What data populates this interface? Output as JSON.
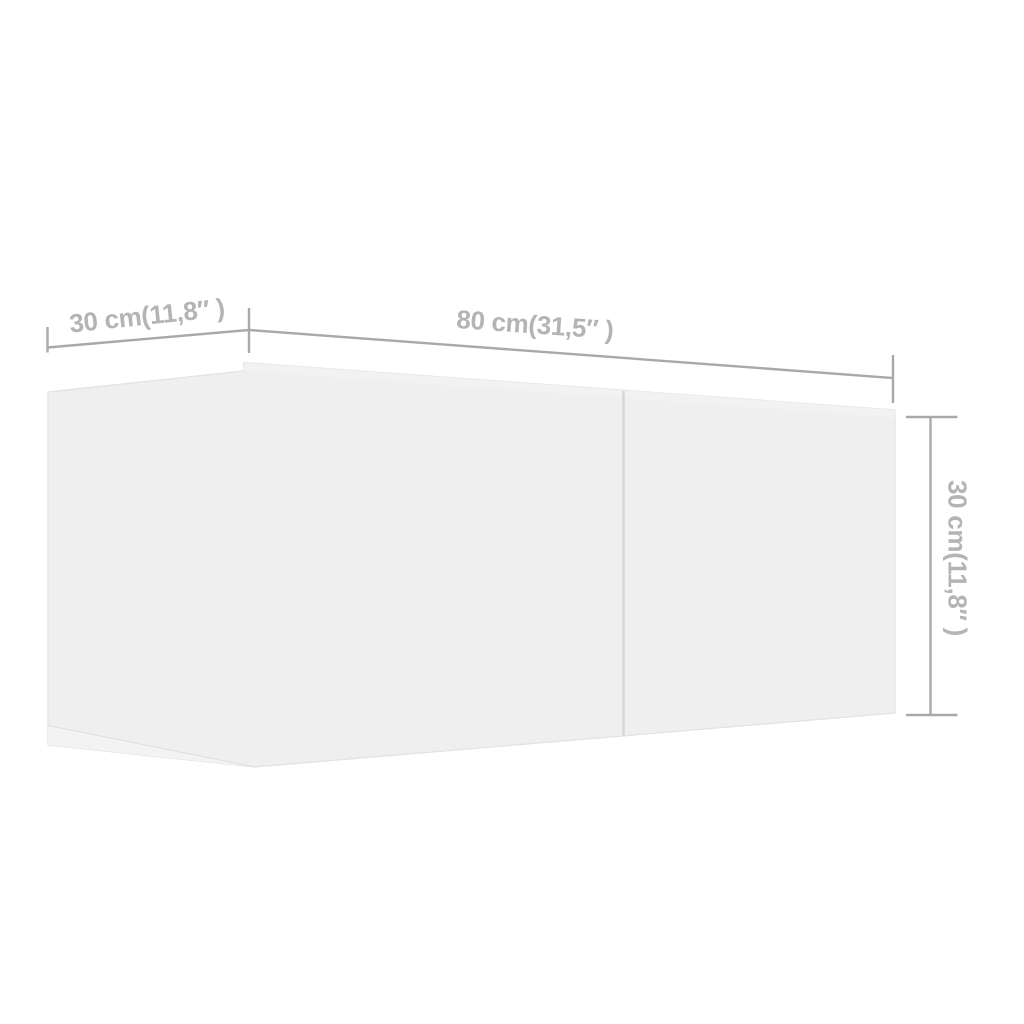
{
  "page": {
    "background_color": "#ffffff",
    "description": "3D dimension diagram of a white wall-mounted TV cabinet with one center seam"
  },
  "diagram": {
    "colors": {
      "cabinet_fill": "#efefef",
      "cabinet_top_sliver": "#f2f2f2",
      "cabinet_underside_sliver": "#f3f3f3",
      "cabinet_seam": "#d6d6d6",
      "dimension_lines": "#a9a9a9",
      "label_text": "#b4b4b4"
    },
    "dimensions": {
      "depth": {
        "cm": "30",
        "inches": "11,8",
        "label": "30 cm(11,8″ )"
      },
      "width": {
        "cm": "80",
        "inches": "31,5",
        "label": "80 cm(31,5″ )"
      },
      "height": {
        "cm": "30",
        "inches": "11,8",
        "label": "30 cm(11,8″ )"
      }
    }
  }
}
